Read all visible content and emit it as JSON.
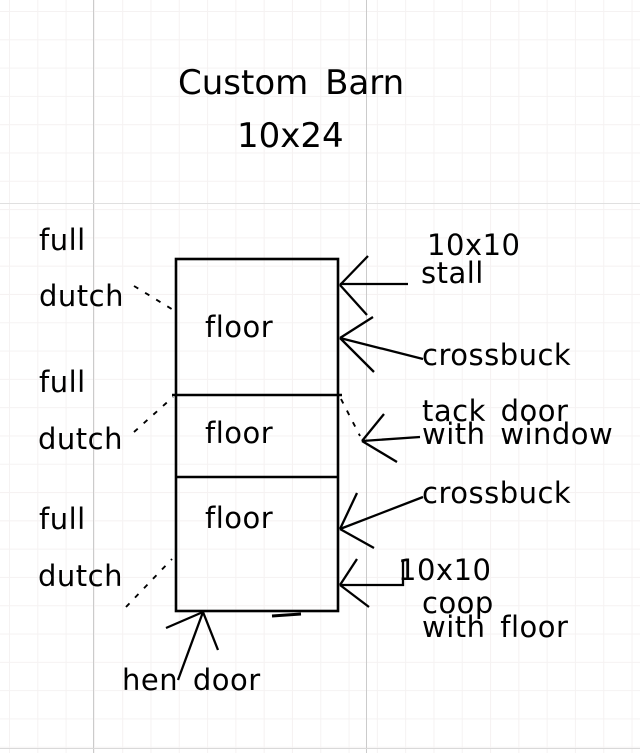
{
  "title": {
    "name": "Custom Barn",
    "size": "10x24"
  },
  "barn": {
    "floor_labels": [
      "floor",
      "floor",
      "floor"
    ]
  },
  "left_doors": [
    {
      "line1": "full",
      "line2": "dutch"
    },
    {
      "line1": "full",
      "line2": "dutch"
    },
    {
      "line1": "full",
      "line2": "dutch"
    }
  ],
  "right_annotations": {
    "stall_size": "10x10",
    "stall": "stall",
    "crossbuck_upper": "crossbuck",
    "tack_door_line1": "tack door",
    "tack_door_line2": "with window",
    "crossbuck_lower": "crossbuck",
    "coop_size": "10x10",
    "coop_line1": "coop",
    "coop_line2": "with floor"
  },
  "bottom_annotation": {
    "hen_door": "hen door"
  },
  "colors": {
    "ink": "#000000",
    "background": "#ffffff",
    "grid_minor": "#f5f2f2",
    "grid_major_vertical": "#cbcbcb",
    "grid_major_horizontal": "#e0e0e0"
  }
}
